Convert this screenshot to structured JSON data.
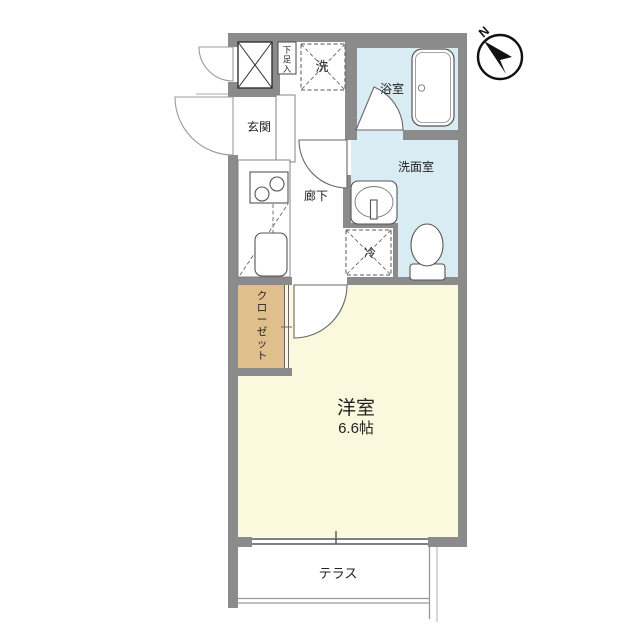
{
  "colors": {
    "wall": "#8b8b8b",
    "wet_area_floor": "#d9ecf4",
    "main_room_floor": "#fbf9dd",
    "closet_fill": "#dfc08d",
    "terrace_fill": "#ffffff",
    "outline": "#555555",
    "exterior_line": "#9a9a9a",
    "compass": "#111111",
    "background": "#ffffff"
  },
  "rooms": {
    "genkan": {
      "label": "玄関"
    },
    "hallway": {
      "label": "廊下"
    },
    "bathroom": {
      "label": "浴室"
    },
    "washroom": {
      "label": "洗面室"
    },
    "main_room": {
      "label": "洋室",
      "size": "6.6帖"
    },
    "closet": {
      "label": "クローゼット"
    },
    "terrace": {
      "label": "テラス"
    }
  },
  "fixtures": {
    "shoe_cabinet": {
      "label": "下足入"
    },
    "washer_space": {
      "label": "洗"
    },
    "fridge_space": {
      "label": "冷"
    }
  },
  "compass": {
    "north_label": "N"
  }
}
